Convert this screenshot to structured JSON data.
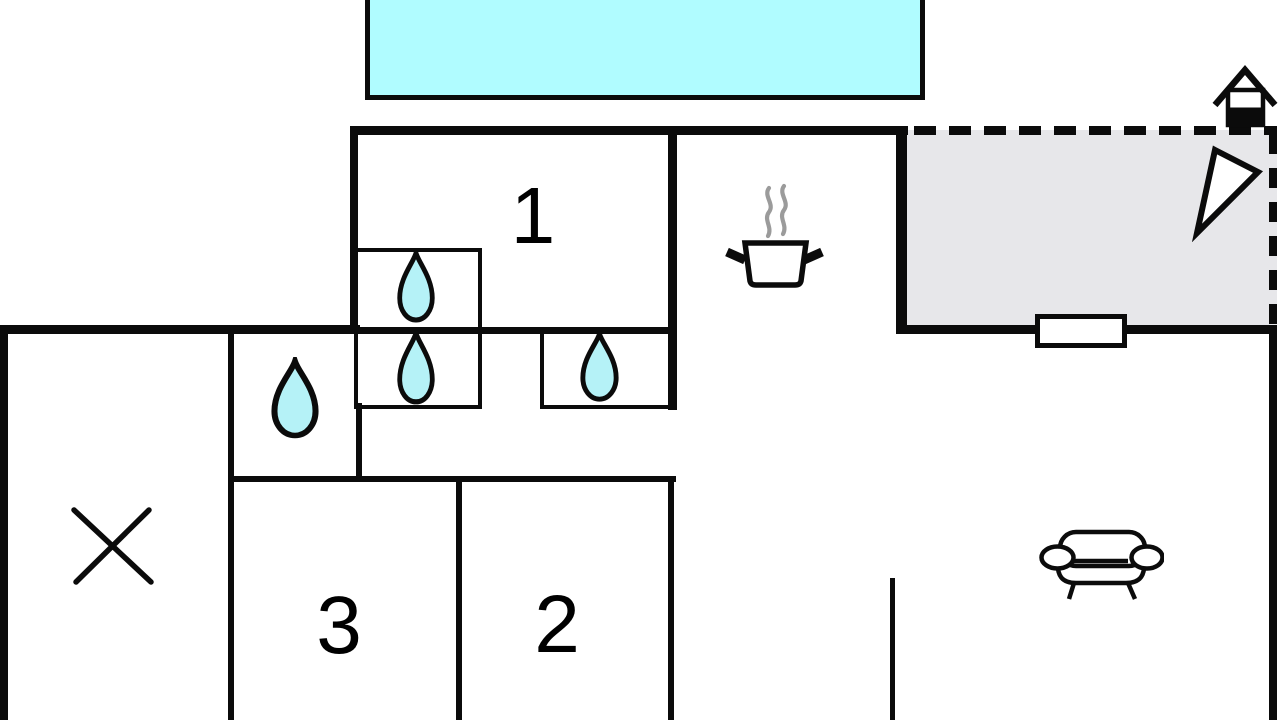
{
  "title": "Holiday home floor plan",
  "colors": {
    "wall": "#0b0b0b",
    "pool": "#b0fcff",
    "terrace": "#e7e7ea",
    "drop": "#b5f2f7",
    "steam": "#9b9b9b",
    "paper": "#ffffff"
  },
  "rooms": [
    {
      "id": "room-1",
      "label": "1"
    },
    {
      "id": "room-2",
      "label": "2"
    },
    {
      "id": "room-3",
      "label": "3"
    }
  ],
  "symbols": {
    "pool": "swimming-pool",
    "terrace": "terrace",
    "house": "house-marker",
    "north_arrow": "north-arrow",
    "pot": "cooking-pot",
    "sofa": "sofa",
    "cross": "cross-mark",
    "drop": "water-drop",
    "window": "window"
  }
}
